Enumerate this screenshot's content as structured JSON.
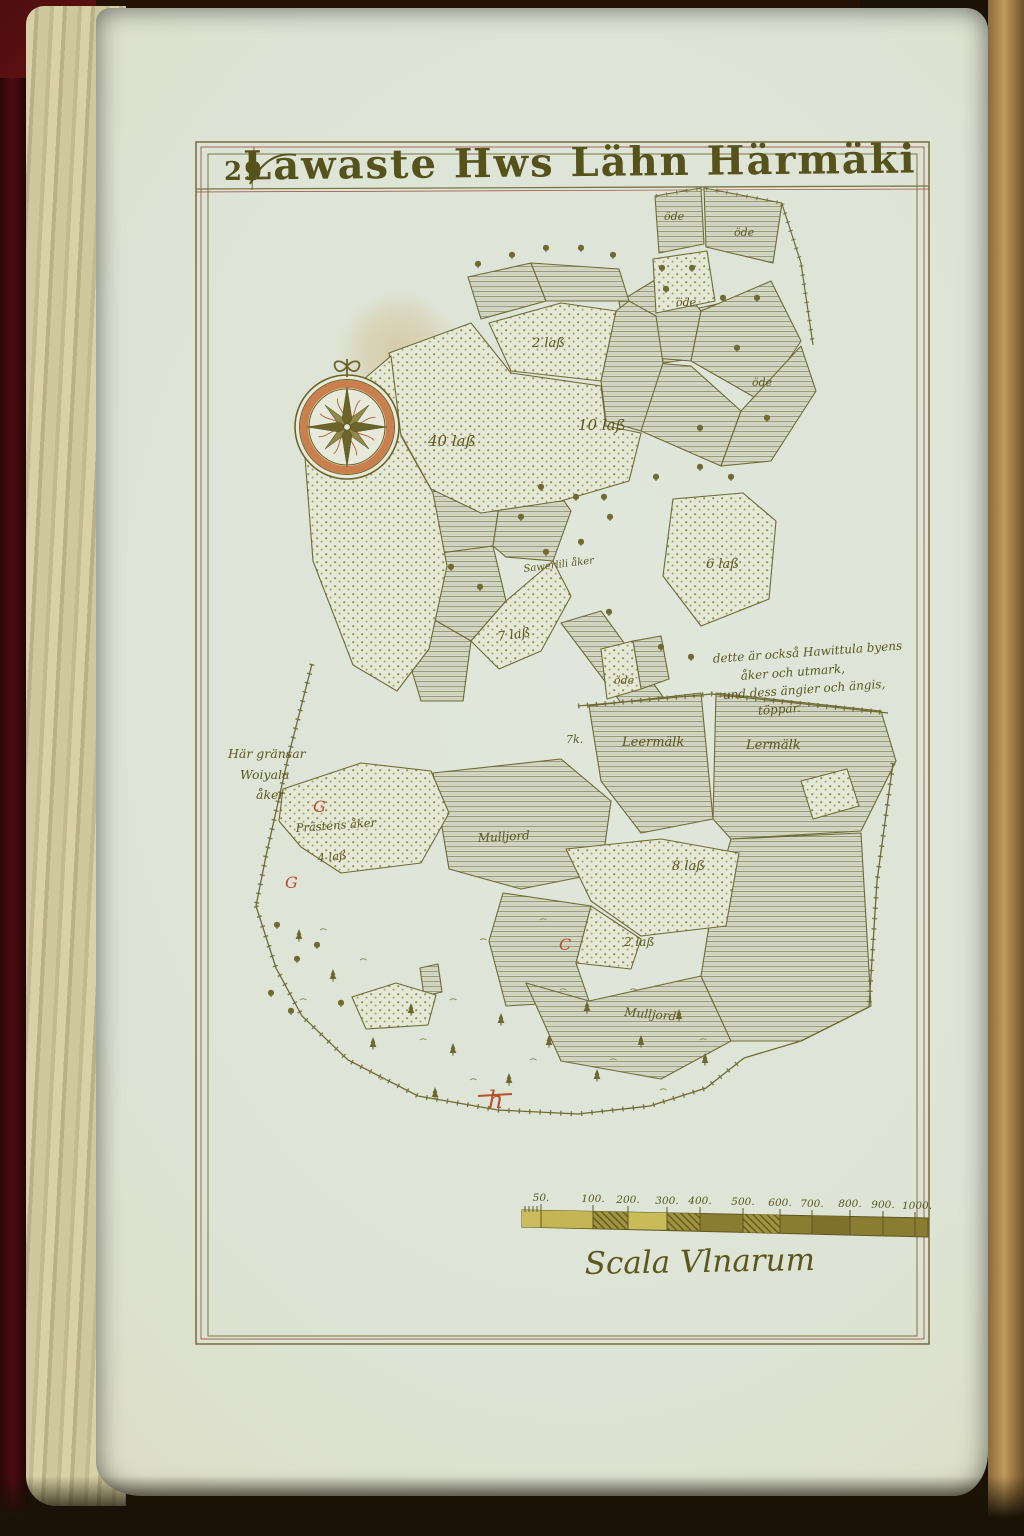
{
  "page": {
    "number": "29",
    "title": "Lawaste Hws Lähn Härmäki"
  },
  "map": {
    "field_labels": [
      {
        "text": "40 laß"
      },
      {
        "text": "10 laß"
      },
      {
        "text": "2 laß"
      },
      {
        "text": "öde"
      },
      {
        "text": "öde"
      },
      {
        "text": "öde"
      },
      {
        "text": "öde"
      },
      {
        "text": "Sawerlili åker"
      },
      {
        "text": "7 laß"
      },
      {
        "text": "6 laß"
      },
      {
        "text": "öde"
      },
      {
        "text": "7k."
      },
      {
        "text": "Leermälk"
      },
      {
        "text": "Lermälk"
      },
      {
        "text": "Prästens åker"
      },
      {
        "text": "4 laß"
      },
      {
        "text": "Mulljord"
      },
      {
        "text": "8 laß"
      },
      {
        "text": "2 laß"
      },
      {
        "text": "Mulljord"
      }
    ],
    "red_marks": [
      {
        "text": "G"
      },
      {
        "text": "G"
      },
      {
        "text": "C"
      },
      {
        "text": "h"
      }
    ],
    "left_note": {
      "lines": [
        "Här gränsar",
        "Woiyala",
        "åker"
      ]
    },
    "right_note": {
      "lines": [
        "dette är också Hawittula byens",
        "åker och utmark,",
        "und dess ängier och ängis,",
        "töppar."
      ]
    }
  },
  "scale_bar": {
    "ticks": [
      "50.",
      "100.",
      "200.",
      "300.",
      "400.",
      "500.",
      "600.",
      "700.",
      "800.",
      "900.",
      "1000."
    ],
    "caption": "Scala Vlnarum"
  },
  "icons": {
    "compass": "compass-rose-icon"
  },
  "colors": {
    "ink_olive": "#6b6428",
    "ink_red": "#b5512f",
    "compass_orange": "#c97f4e",
    "paper": "#dfe5da",
    "paper_edge": "#d3cba0",
    "scale_gold": "#c4b654"
  }
}
